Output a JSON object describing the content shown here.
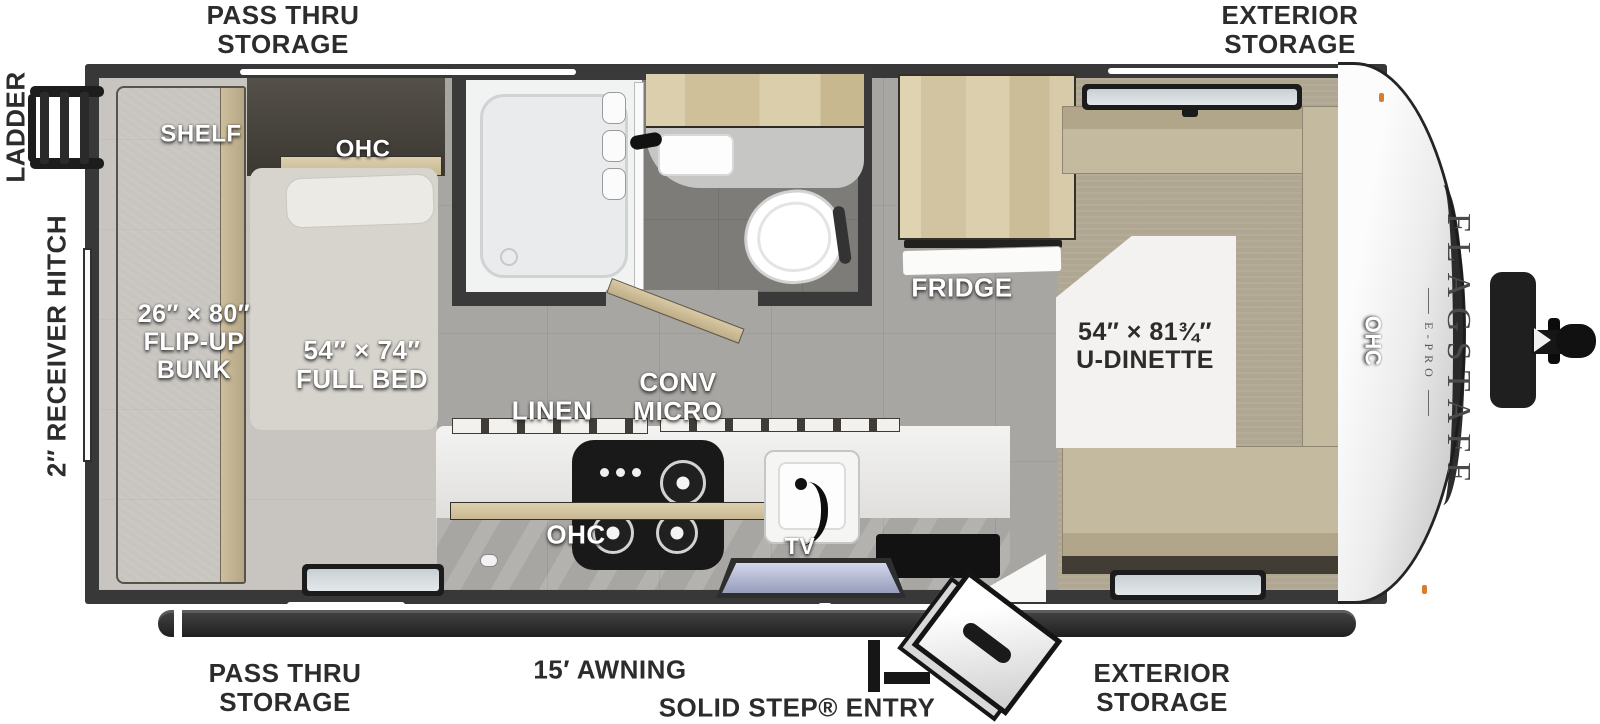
{
  "title": "Flagstaff E-Pro travel trailer floorplan",
  "brand": {
    "name": "FLAGSTAFF",
    "model": "E-PRO"
  },
  "exterior_labels": {
    "pass_thru_storage_top": "PASS THRU\nSTORAGE",
    "exterior_storage_top": "EXTERIOR\nSTORAGE",
    "ladder": "LADDER",
    "receiver_hitch": "2″ RECEIVER HITCH",
    "pass_thru_storage_bottom": "PASS THRU\nSTORAGE",
    "awning": "15′ AWNING",
    "entry": "SOLID STEP® ENTRY",
    "exterior_storage_bottom": "EXTERIOR\nSTORAGE"
  },
  "interior_labels": {
    "shelf": "SHELF",
    "ohc_bed": "OHC",
    "flip_up_bunk": "26″ × 80″\nFLIP-UP\nBUNK",
    "full_bed": "54″ × 74″\nFULL BED",
    "linen": "LINEN",
    "conv_micro": "CONV\nMICRO",
    "fridge": "FRIDGE",
    "u_dinette": "54″ × 81¾″\nU-DINETTE",
    "ohc_dinette": "OHC",
    "ohc_kitchen": "OHC",
    "tv": "TV"
  },
  "colors": {
    "wall": "#383838",
    "floor_tile": "#a8a6a2",
    "bath_floor": "#7e7c78",
    "bed_deck": "#c8c5c0",
    "carpet": "#b0a793",
    "wood": "#d7c9a6",
    "cushion": "#c4ba9f",
    "cooktop": "#191919",
    "label_dark": "#2c2c2c",
    "label_light": "#ffffff",
    "marker_light": "#d97c2e"
  }
}
